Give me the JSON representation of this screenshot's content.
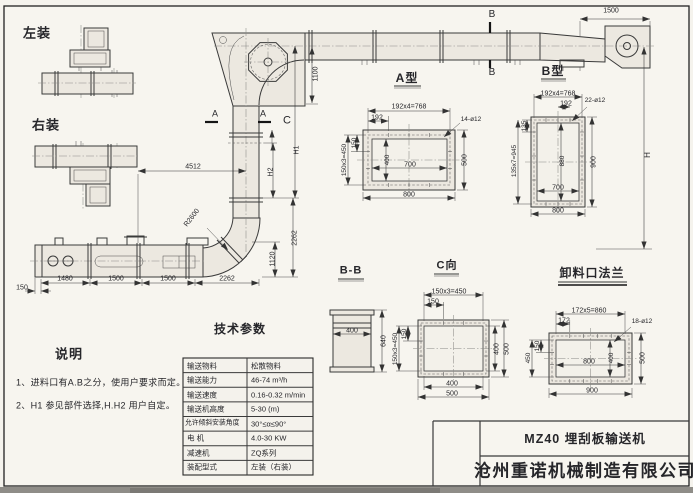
{
  "drawing": {
    "mounts": {
      "left": "左装",
      "right": "右装"
    },
    "markers": {
      "a_left": "A",
      "a_right": "A",
      "c": "C",
      "b_top": "B",
      "b_bottom": "B"
    },
    "dims": {
      "top_1500": "1500",
      "v_1100": "1100",
      "h1": "H1",
      "h2": "H2",
      "v_2262": "2262",
      "v_1120": "1120",
      "total_h": "H",
      "d_4512": "4512",
      "r_2600": "R2600",
      "b_150": "150",
      "b_1480": "1480",
      "b_1500a": "1500",
      "b_1500b": "1500",
      "b_2262": "2262"
    }
  },
  "views": {
    "a_type": {
      "title": "A型",
      "top_pitch": "192x4=768",
      "pitch": "192",
      "holes": "14-ø12",
      "side_150": "150",
      "side_pitch": "150x3=450",
      "inner_h": "400",
      "inner_w": "700",
      "outer_h": "500",
      "outer_w": "800"
    },
    "b_type": {
      "title": "B型",
      "top_pitch": "192x4=768",
      "pitch": "192",
      "holes": "22-ø12",
      "side_135": "135",
      "side_pitch": "135x7=945",
      "inner_h": "880",
      "outer_h": "900",
      "inner_w": "700",
      "outer_w": "800"
    },
    "bb": {
      "title": "B-B",
      "width": "400",
      "height": "640"
    },
    "c_view": {
      "title": "C向",
      "top_pitch": "150x3=450",
      "pitch": "150",
      "side_150": "150",
      "side_pitch": "150x3=450",
      "inner_w": "400",
      "outer_w": "500"
    },
    "discharge": {
      "title": "卸料口法兰",
      "top_pitch": "172x5=860",
      "pitch": "172",
      "holes": "18-ø12",
      "side_150": "150",
      "side_450": "450",
      "inner_w": "800",
      "inner_h": "400",
      "outer_h": "500",
      "outer_w": "900"
    }
  },
  "tech_params": {
    "title": "技术参数",
    "rows": [
      {
        "label": "输送物料",
        "value": "松散物料"
      },
      {
        "label": "输送能力",
        "value": "46-74 m³/h"
      },
      {
        "label": "输送速度",
        "value": "0.16-0.32 m/min"
      },
      {
        "label": "输送机高度",
        "value": "5-30 (m)"
      },
      {
        "label": "允许倾斜安装角度",
        "value": "30°≤α≤90°"
      },
      {
        "label": "电 机",
        "value": "4.0-30 KW"
      },
      {
        "label": "减速机",
        "value": "ZQ系列"
      },
      {
        "label": "装配型式",
        "value": "左装（右装）"
      }
    ]
  },
  "notes": {
    "title": "说明",
    "items": [
      "1、进料口有A.B之分，使用户要求而定。",
      "2、H1 参见部件选择,H.H2 用户自定。"
    ]
  },
  "title_block": {
    "model": "MZ40  埋刮板输送机",
    "company": "沧州重诺机械制造有限公司"
  }
}
